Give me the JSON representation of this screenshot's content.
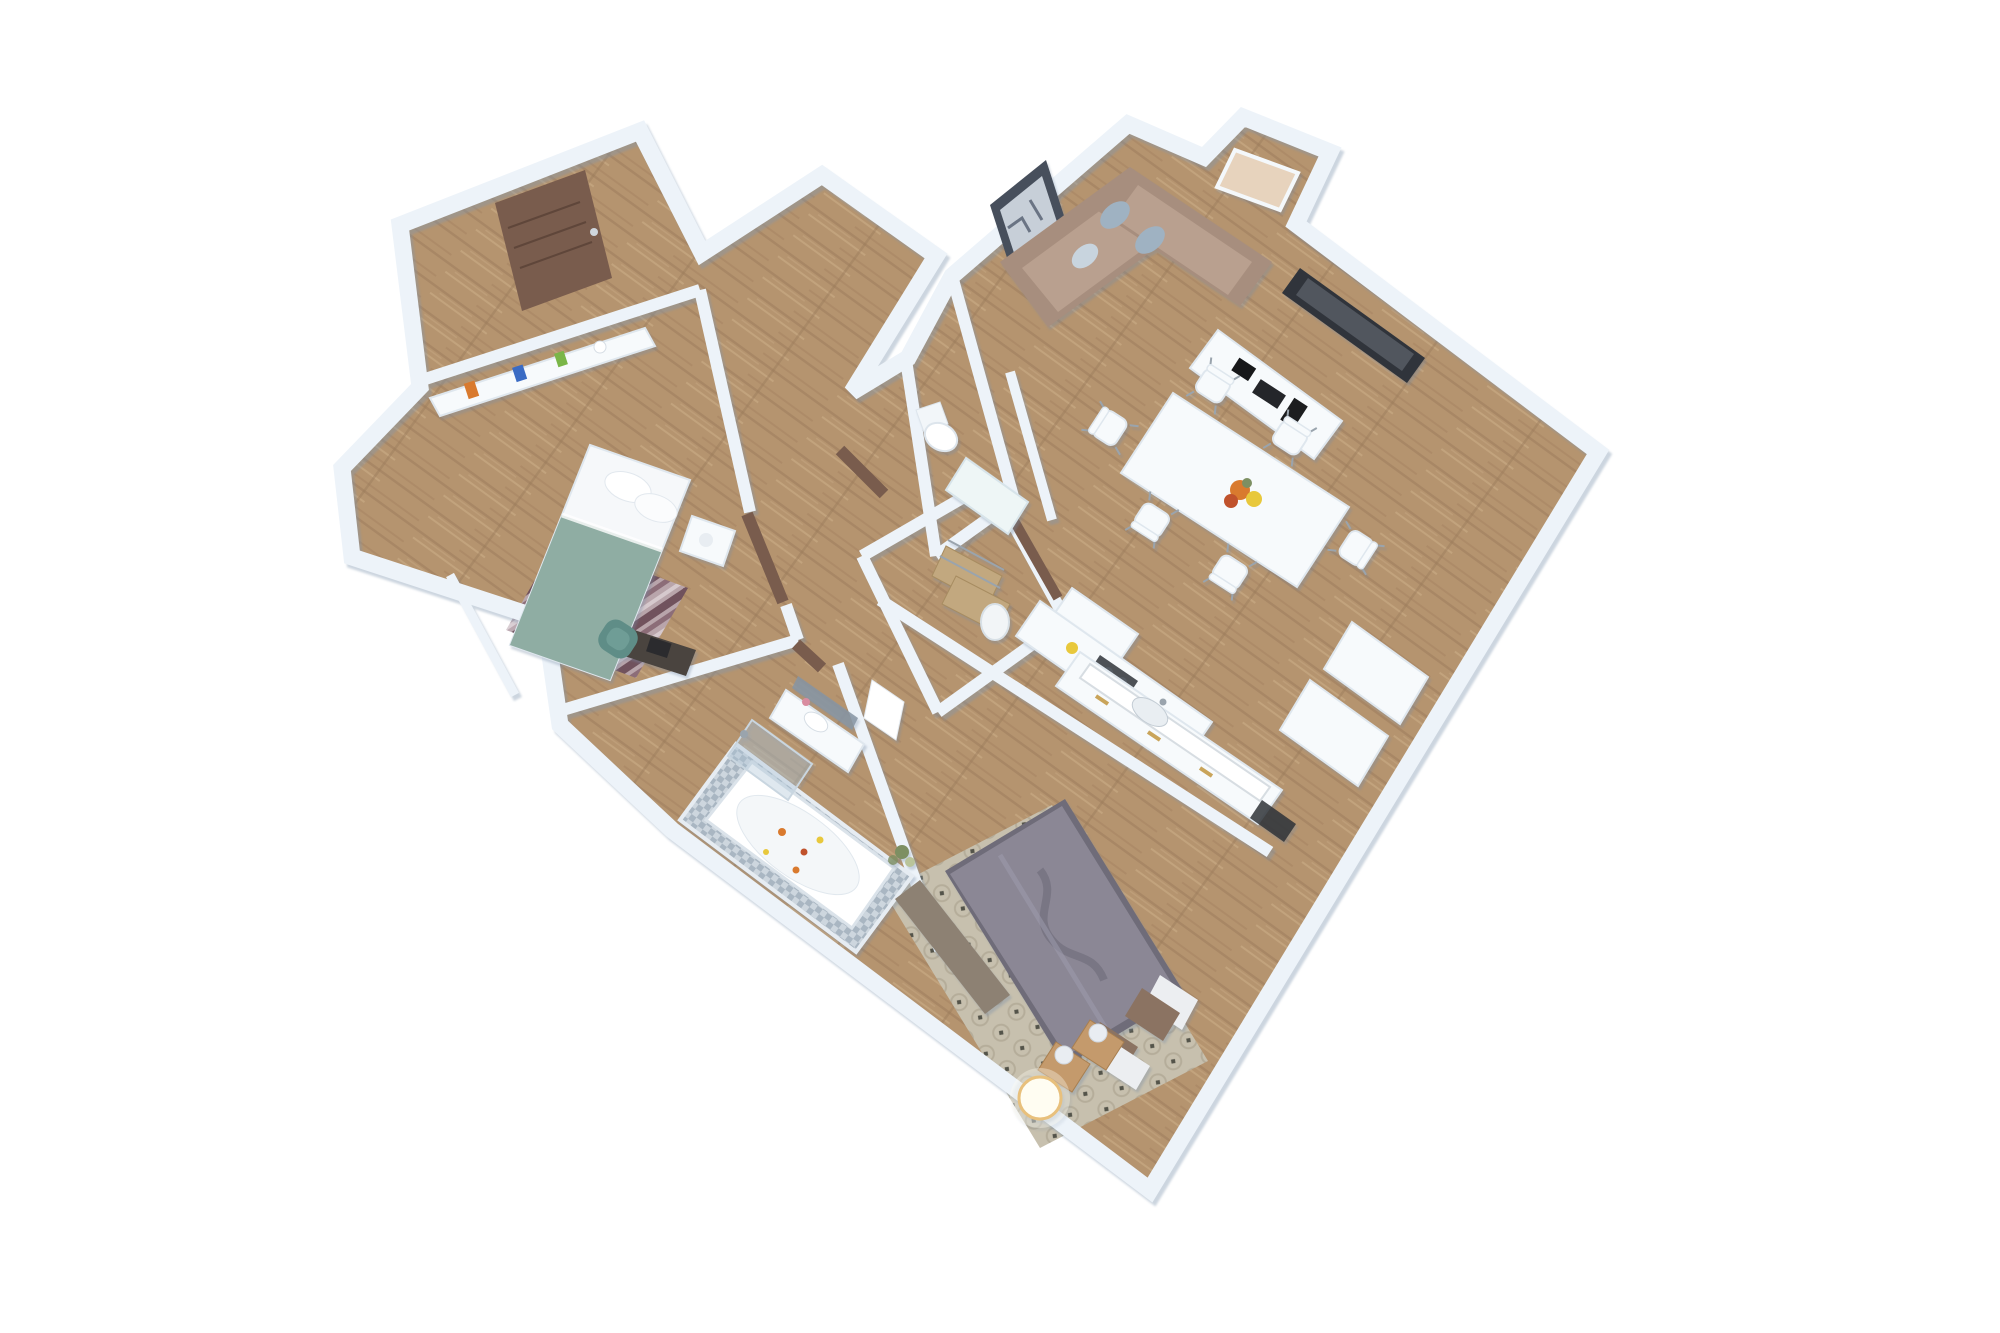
{
  "scene": {
    "kind": "isometric-3d-floor-plan-render",
    "background": "#ffffff",
    "rooms": [
      {
        "name": "entry-hall"
      },
      {
        "name": "hallway"
      },
      {
        "name": "bedroom-2"
      },
      {
        "name": "wc-toilet-room"
      },
      {
        "name": "bathroom"
      },
      {
        "name": "laundry-closet"
      },
      {
        "name": "living-dining-room"
      },
      {
        "name": "kitchen"
      },
      {
        "name": "master-bedroom"
      }
    ],
    "furniture": [
      "front-door",
      "double-bed-teal",
      "headboard-shelf",
      "striped-rug",
      "desk",
      "teal-armchair",
      "bathtub-with-petals",
      "shower",
      "vanity-sink",
      "towel",
      "wall-hung-toilet",
      "storage-shelves",
      "water-heater",
      "sectional-sofa",
      "wall-picture",
      "window",
      "tv",
      "media-console",
      "dining-table",
      "dining-chairs",
      "flower-centerpiece",
      "kitchen-island",
      "kitchen-counter",
      "fridge-cabinets",
      "master-bed",
      "quatrefoil-rug",
      "nightstands",
      "sphere-lamps",
      "floor-lamp-glowing",
      "bench",
      "plant"
    ]
  },
  "colors": {
    "background": "#ffffff",
    "wall": "#edf3f9",
    "wallEdge": "#c3d2e1",
    "woodBase": "#b5946f",
    "woodDark": "#9c7c5c",
    "woodLight": "#c9aa85",
    "doorBrown": "#795c4d",
    "sofaBase": "#a78e7e",
    "sofaSeat": "#b9a08f",
    "pillowBlue": "#9fb2c2",
    "pillowLight": "#c8d4de",
    "tealBlanket": "#8fada3",
    "sheetWhite": "#f6f8fa",
    "rugStripeA": "#6d4f5c",
    "rugStripeB": "#b9a6ae",
    "rugStripeC": "#8a6b78",
    "duvetGray": "#8b8795",
    "duvetShadow": "#6e6a7a",
    "pillowBrown": "#8b7362",
    "quatreRug": "#c7c0ae",
    "quatreAccent": "#54544a",
    "furnWood": "#c49a6c",
    "benchGray": "#8d8173",
    "furnWhite": "#f7fafc",
    "furnWhiteEdge": "#dfe7ee",
    "tealChair": "#5f8d87",
    "deskDark": "#4a443f",
    "mirrorBlue": "#8795a3",
    "glassBlue": "rgba(176,198,214,0.40)",
    "tvFrame": "#30343b",
    "tvScreen": "#51565e",
    "pictureFrame": "#474f5c",
    "pictureInner": "#c7cfd8",
    "windowTan": "#e7d3bd",
    "metalGray": "#9aa4ad",
    "goldHandle": "#c9a45a",
    "cooktopDark": "#3a3e44",
    "basketTan": "#c2a87f",
    "mosaicA": "#a9b6c2",
    "mosaicB": "#cdd6de",
    "lampGlow": "#fffdf2",
    "lampRing": "#e8c07c",
    "flowerOrange": "#d97a2e",
    "flowerYellow": "#e8c83c",
    "flowerRed": "#c0522c",
    "plantGreen": "#7d8f62"
  }
}
